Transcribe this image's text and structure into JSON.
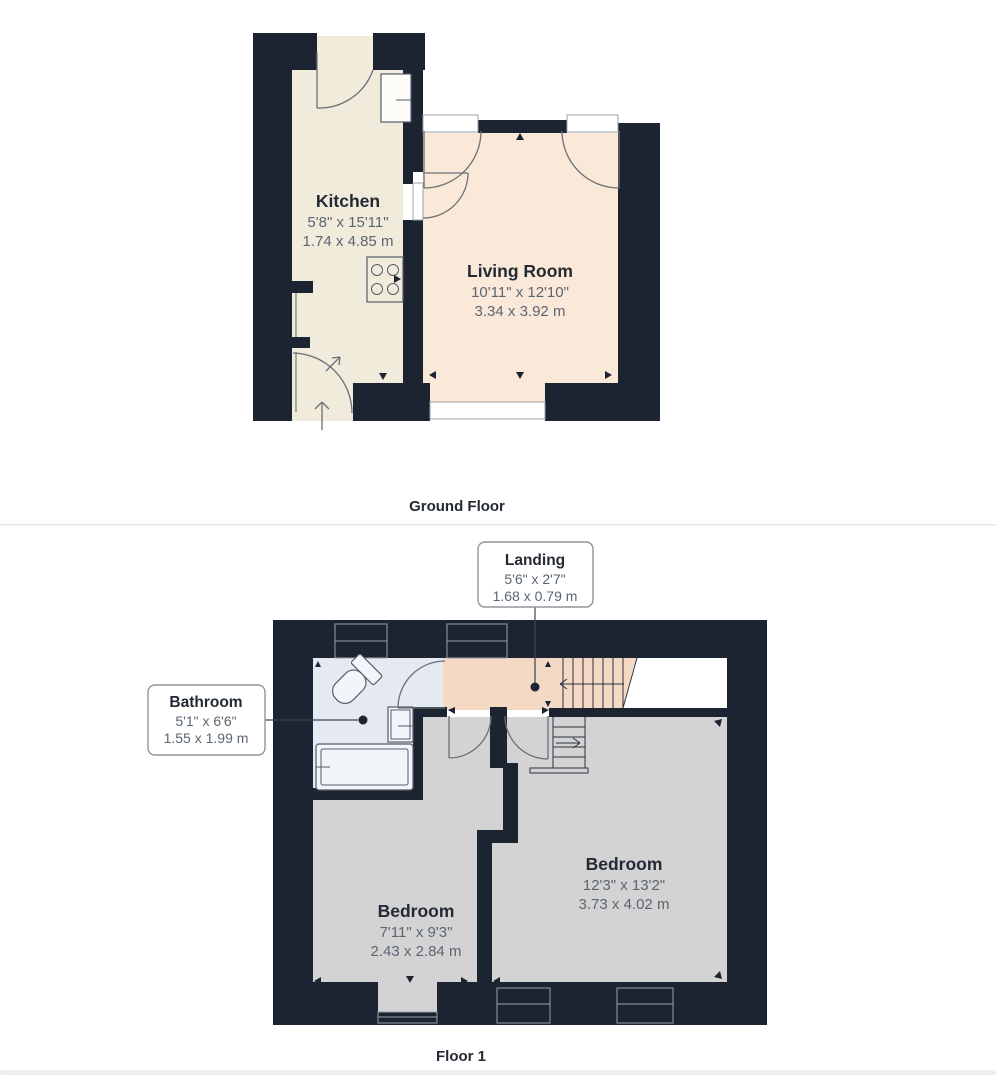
{
  "colors": {
    "wall": "#1c2431",
    "kitchen_floor": "#f0ebdb",
    "living_room_floor": "#fae8d8",
    "landing_floor": "#f4d9c5",
    "bathroom_floor": "#e4e9f2",
    "bedroom_floor": "#d3d3d4",
    "window_white": "#ffffff",
    "background": "#ffffff"
  },
  "ground_floor": {
    "section_label": "Ground Floor",
    "rooms": [
      {
        "name": "Kitchen",
        "imperial": "5'8\" x 15'11\"",
        "metric": "1.74 x 4.85 m"
      },
      {
        "name": "Living Room",
        "imperial": "10'11\" x 12'10\"",
        "metric": "3.34 x 3.92 m"
      }
    ]
  },
  "floor1": {
    "section_label": "Floor 1",
    "callouts": [
      {
        "name": "Landing",
        "imperial": "5'6\" x 2'7\"",
        "metric": "1.68 x 0.79 m"
      },
      {
        "name": "Bathroom",
        "imperial": "5'1\" x 6'6\"",
        "metric": "1.55 x 1.99 m"
      }
    ],
    "rooms": [
      {
        "name": "Bedroom",
        "imperial": "7'11\" x 9'3\"",
        "metric": "2.43 x 2.84 m"
      },
      {
        "name": "Bedroom",
        "imperial": "12'3\" x 13'2\"",
        "metric": "3.73 x 4.02 m"
      }
    ]
  }
}
